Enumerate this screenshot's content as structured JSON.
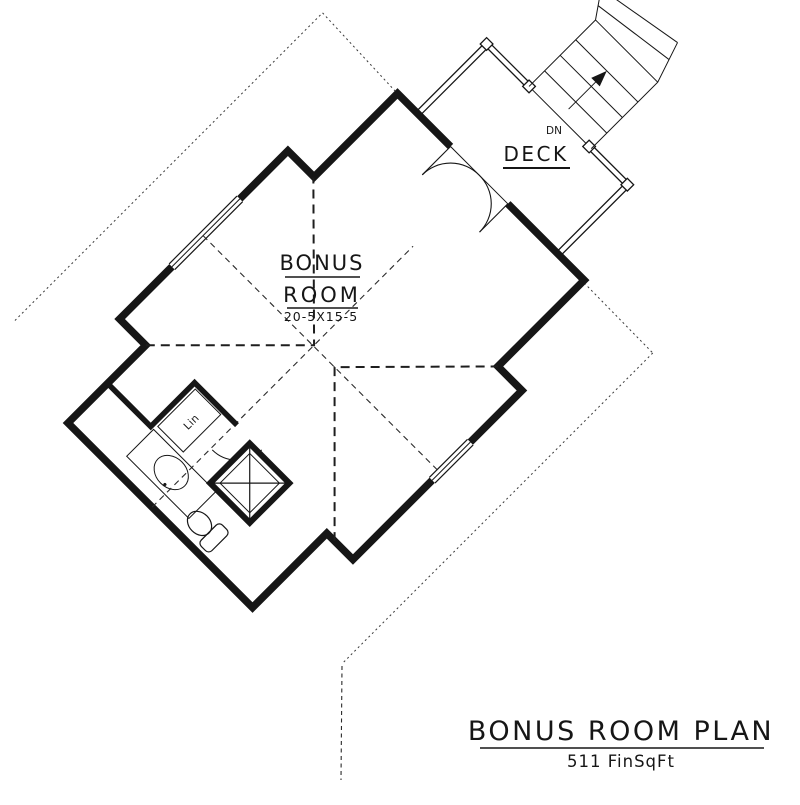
{
  "plan": {
    "room": {
      "name_line1": "BONUS",
      "name_line2": "ROOM",
      "dimensions": "20-5X15-5"
    },
    "deck": {
      "label": "DECK",
      "stair_label": "DN"
    },
    "bathroom": {
      "closet_label": "Lin"
    },
    "title_block": {
      "title": "BONUS ROOM PLAN",
      "area": "511 FinSqFt"
    },
    "colors": {
      "ink": "#161616",
      "background": "#ffffff"
    }
  }
}
